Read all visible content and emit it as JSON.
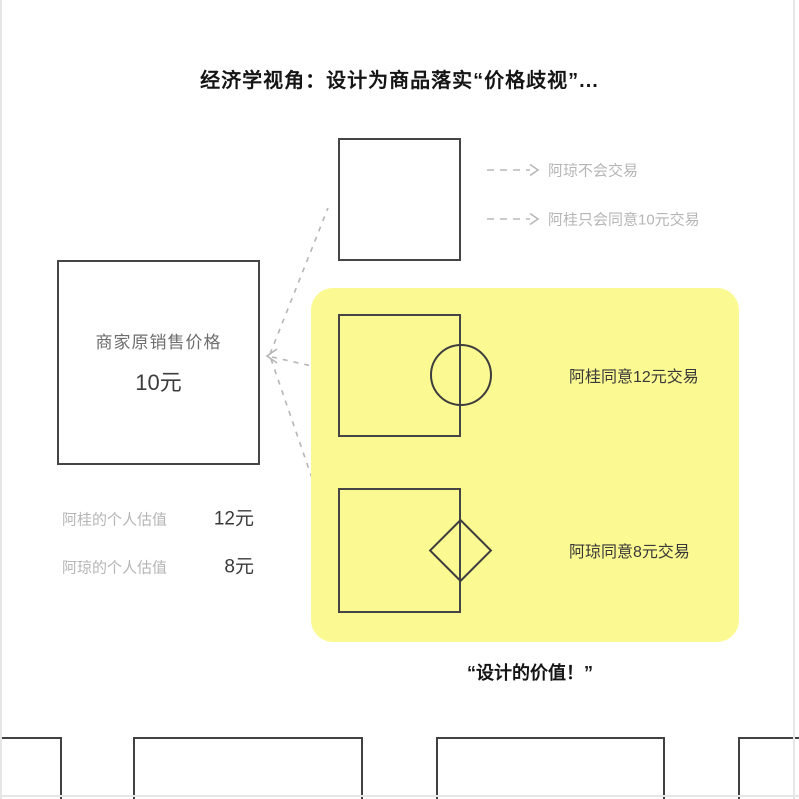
{
  "title": "经济学视角：设计为商品落实“价格歧视”...",
  "merchant_box": {
    "label": "商家原销售价格",
    "price": "10元"
  },
  "no_design_outcomes": [
    {
      "label": "阿琼不会交易"
    },
    {
      "label": "阿桂只会同意10元交易"
    }
  ],
  "design_outcomes": [
    {
      "shape": "circle",
      "label": "阿桂同意12元交易"
    },
    {
      "shape": "diamond",
      "label": "阿琼同意8元交易"
    }
  ],
  "valuations": [
    {
      "label": "阿桂的个人估值",
      "value": "12元"
    },
    {
      "label": "阿琼的个人估值",
      "value": "8元"
    }
  ],
  "caption": "“设计的价值！”",
  "colors": {
    "highlight": "#FBF992",
    "box_border": "#454545",
    "muted_gray": "#b5b5b5",
    "text_dark": "#383838"
  }
}
